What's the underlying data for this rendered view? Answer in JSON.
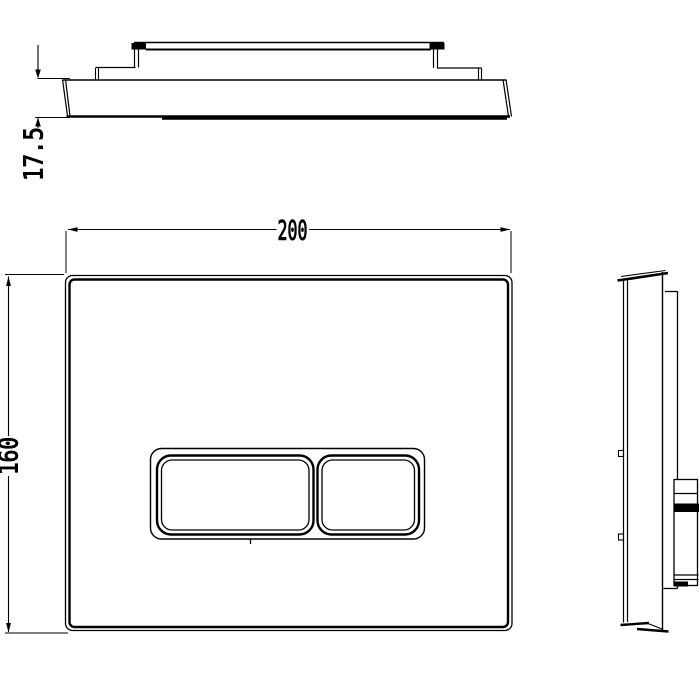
{
  "dimensions": {
    "plate_width": "200",
    "plate_height": "160",
    "plate_thickness": "17.5"
  },
  "colors": {
    "line": "#000000",
    "background": "#ffffff"
  }
}
